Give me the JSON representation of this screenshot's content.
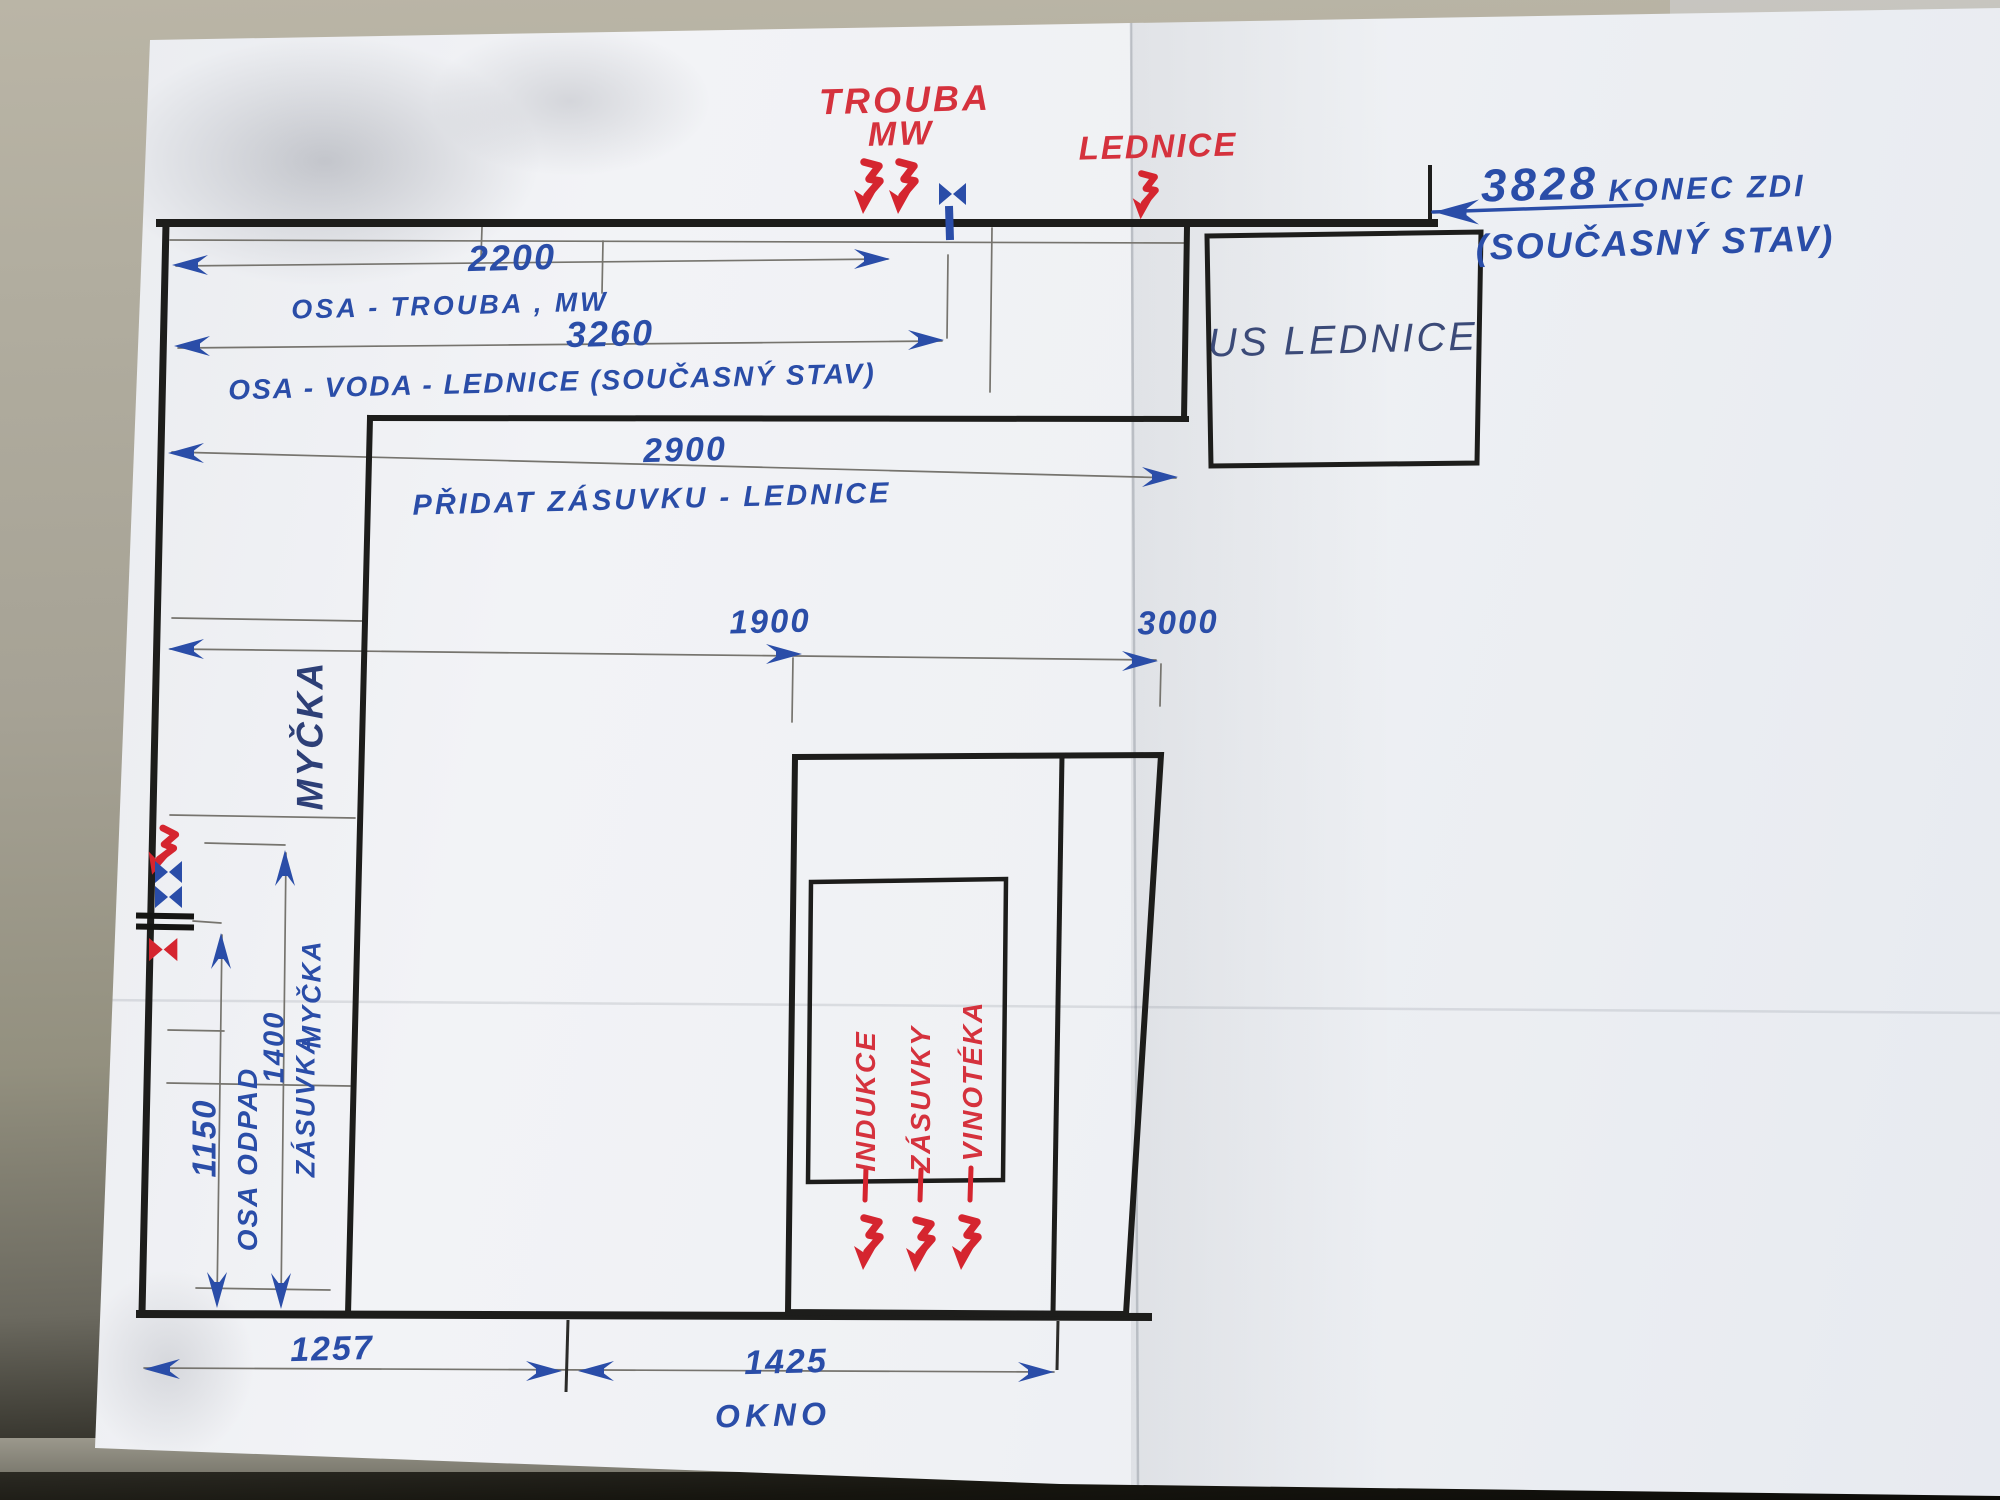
{
  "annotations": {
    "trouba": {
      "line1": "TROUBA",
      "line2": "MW"
    },
    "lednice": "LEDNICE",
    "wall_end": {
      "value": "3828",
      "label": "KONEC ZDI",
      "sub": "(SOUČASNÝ STAV)"
    },
    "old_fridge": "US LEDNICE",
    "dishwasher": "MYČKA",
    "island_items": [
      "INDUKCE",
      "ZÁSUVKY",
      "VINOTÉKA"
    ],
    "dims": {
      "d2200": {
        "value": "2200",
        "label": "OSA - TROUBA , MW"
      },
      "d3260": {
        "value": "3260",
        "label": "OSA - VODA - LEDNICE  (SOUČASNÝ STAV)"
      },
      "d2900": {
        "value": "2900",
        "label": "PŘIDAT ZÁSUVKU - LEDNICE"
      },
      "d1900": {
        "value": "1900"
      },
      "d3000": {
        "value": "3000"
      },
      "d1150": {
        "value": "1150",
        "label": "OSA ODPAD"
      },
      "d1400": {
        "value": "1400",
        "label_word1": "ZÁSUVKA",
        "label_word2": "MYČKA"
      },
      "d1257": {
        "value": "1257"
      },
      "d1425": {
        "value": "1425",
        "label": "OKNO"
      }
    }
  },
  "colors": {
    "ink_blue": "#2a4da8",
    "ink_red": "#d5323d",
    "marker_black": "#1d1d1b",
    "pen_dark_blue": "#3b4a78",
    "pencil_gray": "#76746e",
    "paper": "#eff1f4",
    "desk": "#aba798"
  }
}
